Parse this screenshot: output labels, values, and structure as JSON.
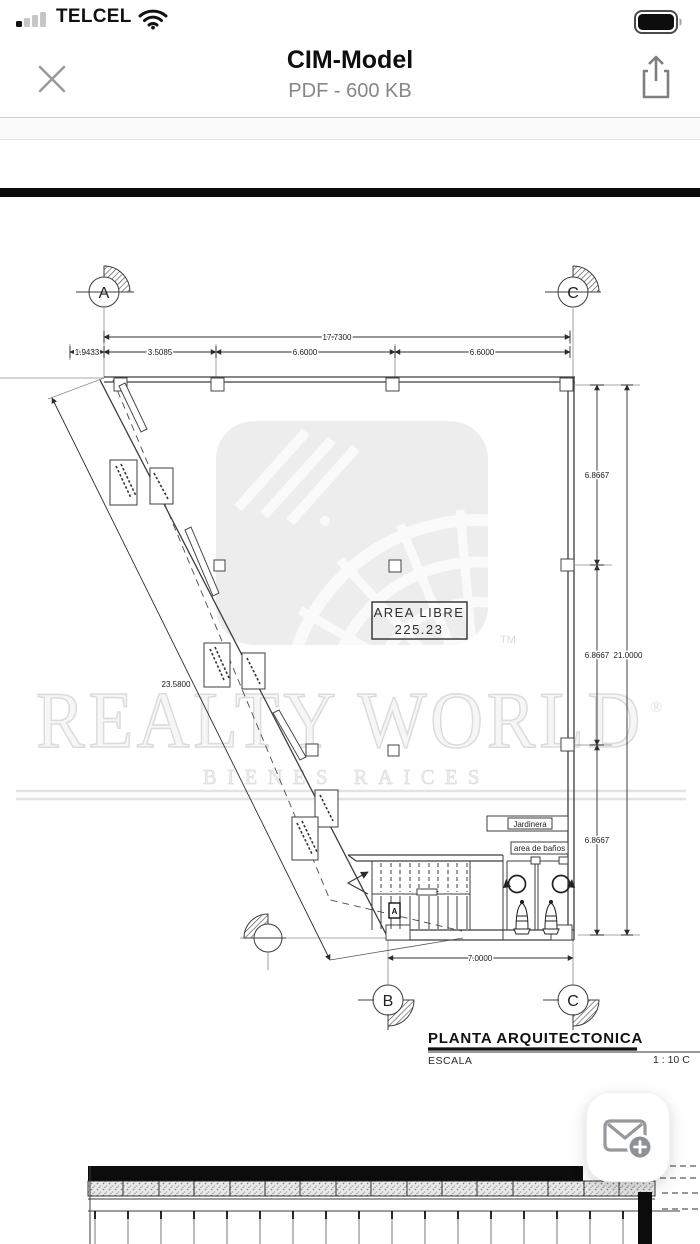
{
  "sb": {
    "carrier": "TELCEL",
    "time": "13:21"
  },
  "header": {
    "title": "CIM-Model",
    "subtitle": "PDF - 600 KB"
  },
  "wm": {
    "brand": "REALTY WORLD",
    "reg": "®",
    "tm": "TM",
    "tagline": "BIENES RAICES"
  },
  "plan": {
    "bubbles": {
      "a": "A",
      "c_top": "C",
      "b": "B",
      "c_bottom": "C"
    },
    "dims": {
      "total_top": "17.7300",
      "seg1": "1.9433",
      "seg2": "3.5085",
      "seg3": "6.6000",
      "seg4": "6.6000",
      "right_top": "6.8667",
      "right_mid": "6.8667",
      "right_total": "21.0000",
      "right_bottom": "6.8667",
      "diagonal": "23.5800",
      "bottom": "7.0000"
    },
    "area": {
      "line1": "AREA LIBRE",
      "line2": "225.23"
    },
    "labels": {
      "jardinera": "Jardinera",
      "banos": "area de baños",
      "stair_tag": "A"
    },
    "titleblock": {
      "title": "PLANTA ARQUITECTONICA",
      "escala": "ESCALA",
      "scale": "1 : 10 C"
    }
  }
}
